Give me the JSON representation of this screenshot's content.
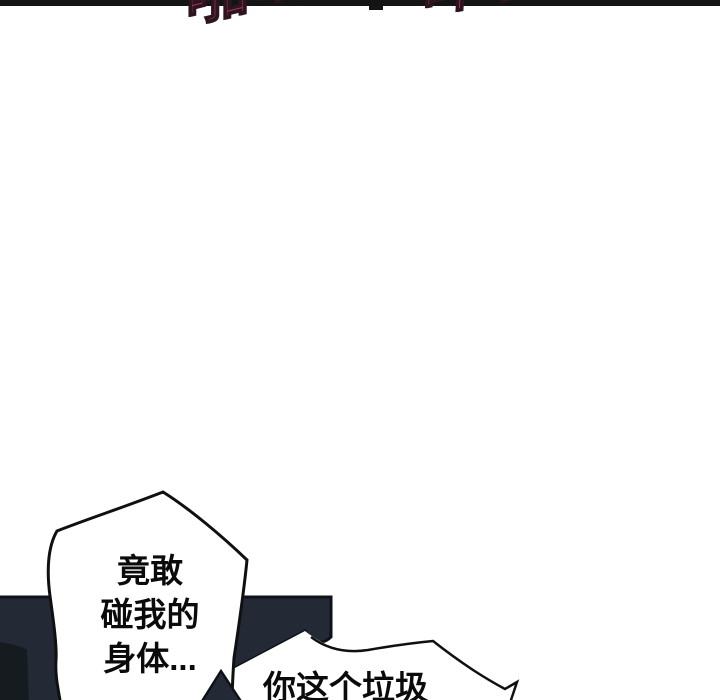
{
  "page": {
    "background_color": "#ffffff",
    "divider_color": "#141414"
  },
  "sfx": {
    "left_text": "啪哟",
    "right_text": "哗啦",
    "color": "#9e3551",
    "note_visible_state": "cropped at top edge"
  },
  "bottom_panel": {
    "fill_color": "#232a36",
    "outline_color": "#0e1116",
    "shadow_color": "#161b20"
  },
  "bubbles": {
    "bubble1": {
      "lines": [
        "竟敢",
        "碰我的",
        "身体..."
      ]
    },
    "bubble2": {
      "text": "你这个垃圾"
    }
  }
}
